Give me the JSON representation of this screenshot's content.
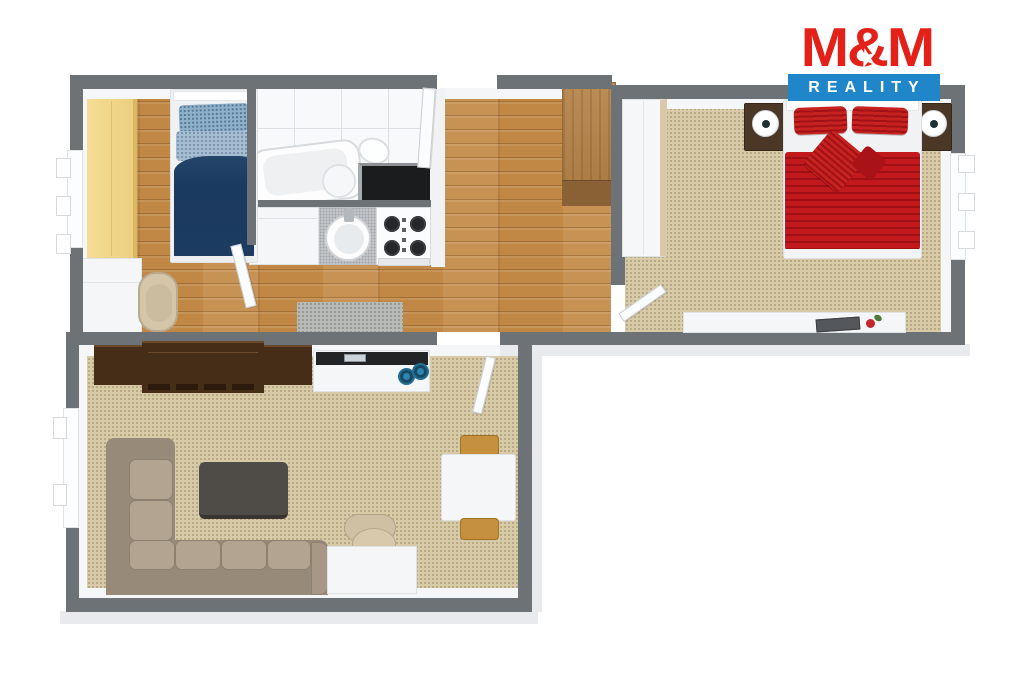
{
  "logo": {
    "brand": "M&M",
    "star_glyph": "★",
    "tagline": "REALITY",
    "brand_color": "#e32119",
    "band_color": "#1e86c9"
  },
  "palette": {
    "wall_gray": "#6d7277",
    "wood_floor": "#c18845",
    "carpet_beige": "#d8cba8",
    "bath_tile": "#f7f9fa",
    "kids_bed_navy": "#1d3b61",
    "double_bed_red": "#c2191d",
    "sofa_taupe": "#b3a492",
    "media_unit_brown": "#462d17",
    "wardrobe_yellow": "#f0d489",
    "hall_wardrobe_wood": "#b08047",
    "bowl_blue": "#2f85ad"
  },
  "plan": {
    "type": "3d-floor-plan",
    "rooms": [
      {
        "id": "children-room",
        "floor": "wood",
        "furniture": [
          "yellow-wardrobe",
          "single-bed-navy",
          "white-dresser",
          "desk-chair"
        ]
      },
      {
        "id": "bathroom",
        "floor": "tile",
        "furniture": [
          "corner-bathtub",
          "toilet",
          "dark-counter"
        ]
      },
      {
        "id": "kitchen",
        "floor": "wood",
        "furniture": [
          "white-cabinet",
          "sink-counter",
          "gas-stove"
        ]
      },
      {
        "id": "hallway",
        "floor": "wood",
        "furniture": [
          "wood-wardrobe",
          "door-mat",
          "entry-door"
        ]
      },
      {
        "id": "bedroom",
        "floor": "carpet",
        "furniture": [
          "double-bed-red",
          "nightstand-left",
          "nightstand-right",
          "white-wardrobe",
          "desk-with-laptop",
          "window-shelf"
        ]
      },
      {
        "id": "living-room",
        "floor": "carpet",
        "furniture": [
          "corner-sofa",
          "coffee-table",
          "media-wall-unit",
          "white-sideboard-hifi",
          "office-chair",
          "white-desk",
          "dining-table",
          "two-wood-chairs"
        ]
      }
    ]
  }
}
